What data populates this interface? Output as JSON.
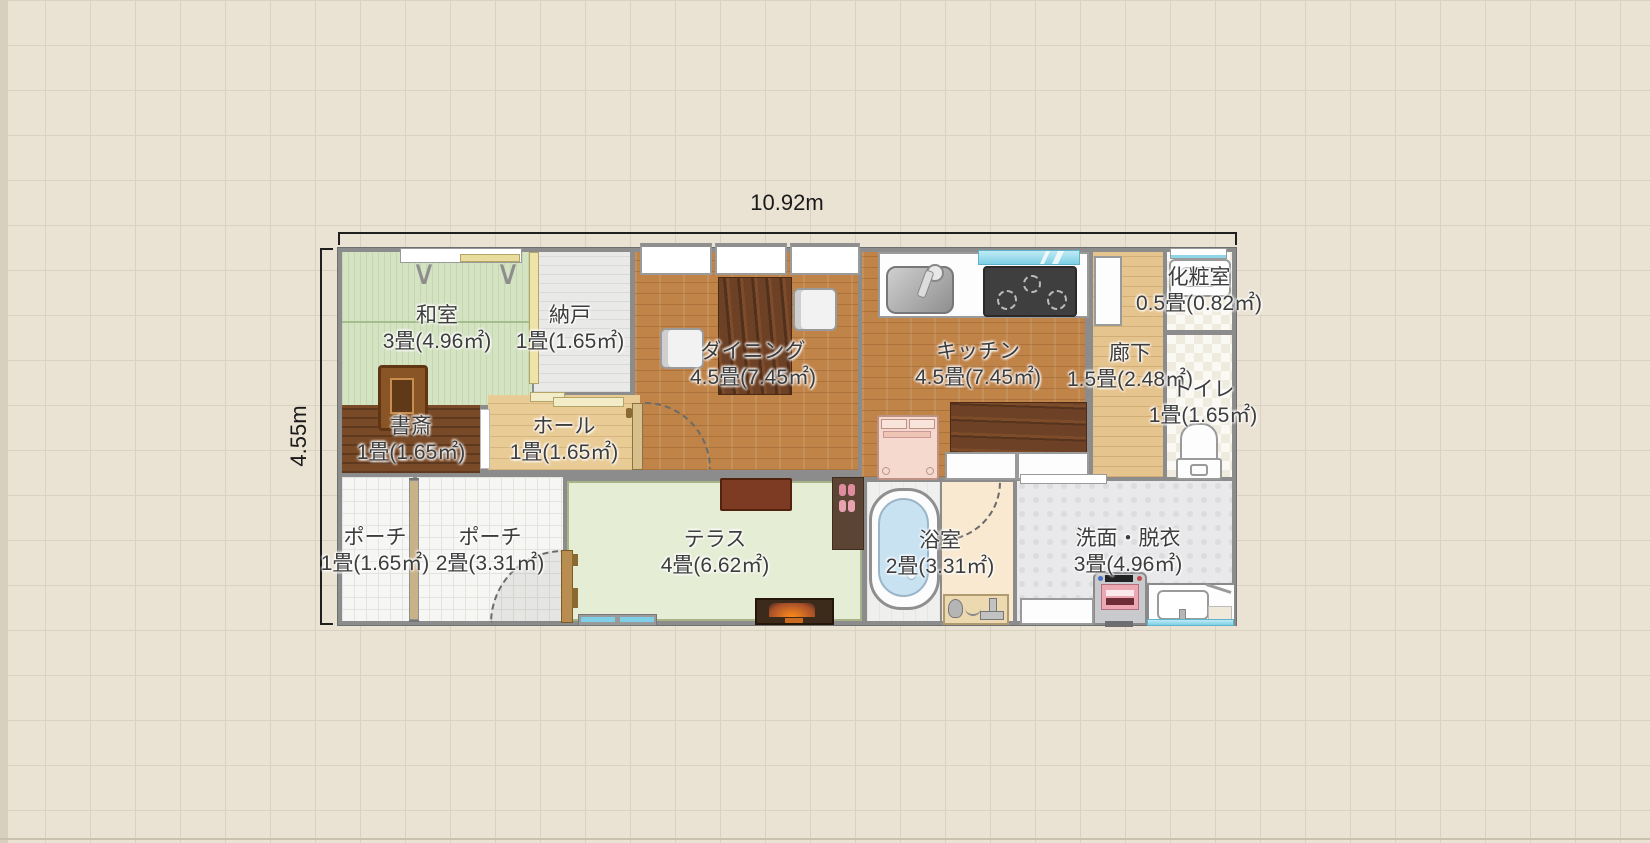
{
  "plan": {
    "dimensions": {
      "width_label": "10.92m",
      "height_label": "4.55m"
    },
    "rooms": {
      "washitsu": {
        "name": "和室",
        "area": "3畳(4.96㎡)"
      },
      "nando": {
        "name": "納戸",
        "area": "1畳(1.65㎡)"
      },
      "dining": {
        "name": "ダイニング",
        "area": "4.5畳(7.45㎡)"
      },
      "kitchen": {
        "name": "キッチン",
        "area": "4.5畳(7.45㎡)"
      },
      "rouka": {
        "name": "廊下",
        "area": "1.5畳(2.48㎡)"
      },
      "kesho": {
        "name": "化粧室",
        "area": "0.5畳(0.82㎡)"
      },
      "toilet": {
        "name": "トイレ",
        "area": "1畳(1.65㎡)"
      },
      "shosai": {
        "name": "書斎",
        "area": "1畳(1.65㎡)"
      },
      "hall": {
        "name": "ホール",
        "area": "1畳(1.65㎡)"
      },
      "porch1": {
        "name": "ポーチ",
        "area": "1畳(1.65㎡)"
      },
      "porch2": {
        "name": "ポーチ",
        "area": "2畳(3.31㎡)"
      },
      "terrace": {
        "name": "テラス",
        "area": "4畳(6.62㎡)"
      },
      "bath": {
        "name": "浴室",
        "area": "2畳(3.31㎡)"
      },
      "senmen": {
        "name": "洗面・脱衣",
        "area": "3畳(4.96㎡)"
      }
    },
    "colors": {
      "background": "#eae2d2",
      "grid_line": "#d9d1c1",
      "wall": "#8c8c8c",
      "tatami": "#d4e3c2",
      "brick_floor": "#c08348",
      "wood_floor": "#e6c48e",
      "terrace": "#e5edd5",
      "window_glass": "#7fd0e6",
      "label_text": "#3d3d3d"
    }
  }
}
